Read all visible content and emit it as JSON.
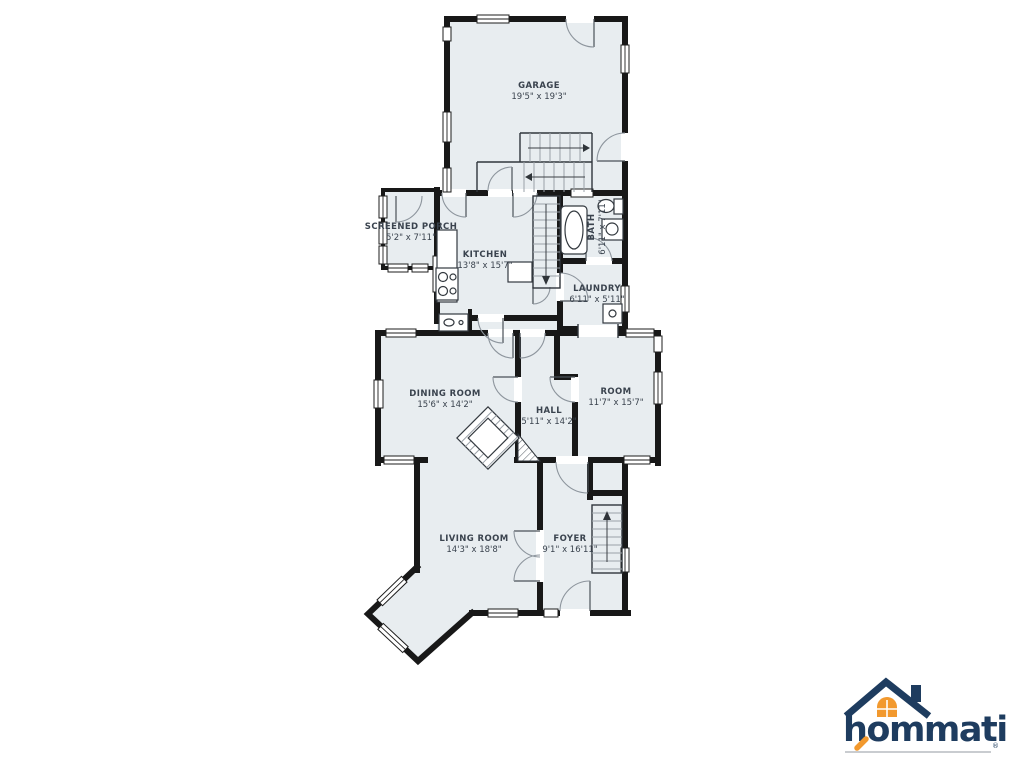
{
  "colors": {
    "room_fill": "#e8edf0",
    "wall": "#181818",
    "label_text": "#3a434e",
    "logo_navy": "#1e3c5f",
    "logo_orange": "#f2992e"
  },
  "rooms": [
    {
      "name": "GARAGE",
      "dims": "19'5\" x 19'3\""
    },
    {
      "name": "SCREENED PORCH",
      "dims": "5'2\" x 7'11\""
    },
    {
      "name": "KITCHEN",
      "dims": "13'8\" x 15'7\""
    },
    {
      "name": "BATH",
      "dims": "6'11\" x 7'11\""
    },
    {
      "name": "LAUNDRY",
      "dims": "6'11\" x 5'11\""
    },
    {
      "name": "DINING ROOM",
      "dims": "15'6\" x 14'2\""
    },
    {
      "name": "HALL",
      "dims": "5'11\" x 14'2\""
    },
    {
      "name": "ROOM",
      "dims": "11'7\" x 15'7\""
    },
    {
      "name": "LIVING ROOM",
      "dims": "14'3\" x 18'8\""
    },
    {
      "name": "FOYER",
      "dims": "9'1\" x 16'11\""
    }
  ],
  "logo": {
    "brand": "hommati",
    "registered": "®"
  }
}
